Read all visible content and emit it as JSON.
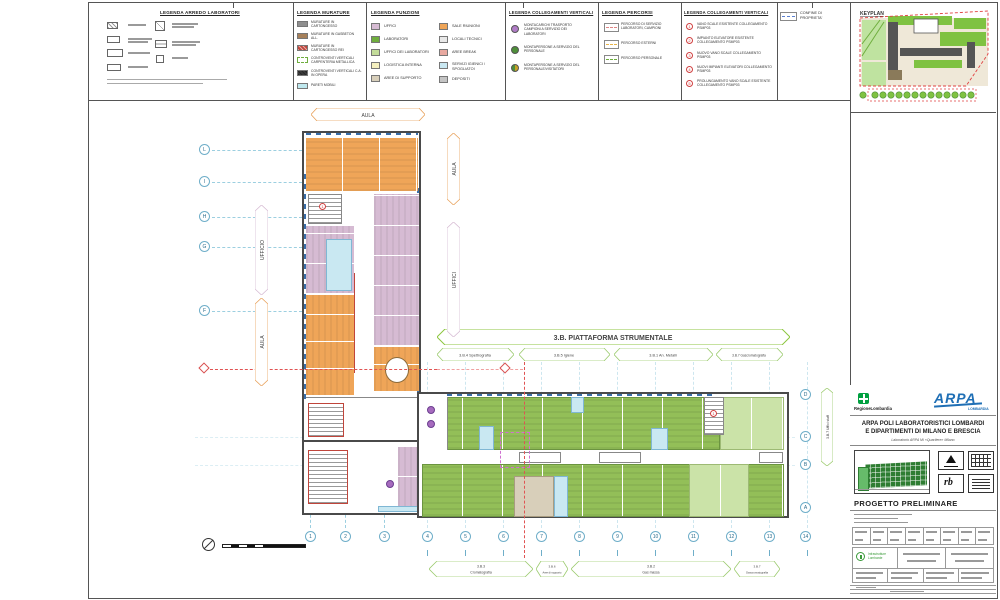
{
  "sheet": {
    "keyplan_title": "KEYPLAN",
    "confine_label": "CONFINE DI PROPRIETA'"
  },
  "colors": {
    "orange": "#EFA558",
    "pink": "#D6BBD3",
    "lab_green": "#93BF58",
    "lab_green_light": "#CBE3A8",
    "cyan": "#C9E8F2",
    "grid_blue": "#6FAEC9",
    "red": "#D94F4F",
    "hex_green": "#8CC63F",
    "beige": "#D8CFBA"
  },
  "legends": {
    "arredo": {
      "title": "LEGENDA ARREDO LABORATORI"
    },
    "murature": {
      "title": "LEGENDA MURATURE",
      "items": [
        {
          "label": "MURATURE IN CARTONGESSO",
          "color": "#8F8F8F"
        },
        {
          "label": "MURATURE IN GASBETON ALL.",
          "color": "#A6805A"
        },
        {
          "label": "MURATURE IN CARTONGESSO REI",
          "color": "#C0453B"
        },
        {
          "label": "CONTROVENTI VERTICALI CARPENTERIA METALLICA",
          "color": "#FFFFFF"
        },
        {
          "label": "CONTROVENTI VERTICALI C.A. IN OPERA",
          "color": "#3A3A3A"
        },
        {
          "label": "PARETI MOBILI",
          "color": "#BFE8EE"
        }
      ]
    },
    "funzioni": {
      "title": "LEGENDA FUNZIONI",
      "col1": [
        {
          "label": "UFFICI",
          "color": "#D6BBD3"
        },
        {
          "label": "LABORATORI",
          "color": "#6FAE3E"
        },
        {
          "label": "UFFICI DEI LABORATORI",
          "color": "#C3DC9A"
        },
        {
          "label": "LOGISTICA INTERNA",
          "color": "#F5F0C0"
        },
        {
          "label": "AREE DI SUPPORTO",
          "color": "#D8CFBA"
        }
      ],
      "col2": [
        {
          "label": "SALE RIUNIONI",
          "color": "#EFA558"
        },
        {
          "label": "LOCALI TECNICI",
          "color": "#E8E8E8"
        },
        {
          "label": "AREE BREAK",
          "color": "#E8A9A0"
        },
        {
          "label": "SERVIZI IGIENICI / SPOGLIATOI",
          "color": "#C9E8F2"
        },
        {
          "label": "DEPOSITI",
          "color": "#C4C4C4"
        }
      ]
    },
    "collegamenti1": {
      "title": "LEGENDA COLLEGAMENTI VERTICALI",
      "items": [
        {
          "label": "MONTACARICHI TRASPORTO CAMPIONI A SERVIZIO DEI LABORATORI",
          "color": "#B07CC6"
        },
        {
          "label": "MONTAPERSONE A SERVIZIO DEL PERSONALE",
          "color": "#4E8F3A"
        },
        {
          "label": "MONTAPERSONE A SERVIZIO DEL PERSONALE/VISITATORI",
          "color": "#4E8F3A"
        }
      ]
    },
    "percorsi": {
      "title": "LEGENDA PERCORSI",
      "items": [
        {
          "label": "PERCORSO DI SERVIZIO LABORATORI, CAMPIONI",
          "color": "#E08585"
        },
        {
          "label": "PERCORSO ESTERNI",
          "color": "#E8B54A"
        },
        {
          "label": "PERCORSO PERSONALE",
          "color": "#6FAE3E"
        }
      ]
    },
    "collegamenti2": {
      "title": "LEGENDA COLLEGAMENTI VERTICALI",
      "items": [
        {
          "num": "1",
          "label": "VANO SCALE ESISTENTE COLLEGAMENTO PSMP03"
        },
        {
          "num": "2",
          "label": "IMPIANTO ELEVATORE ESISTENTE COLLEGAMENTO PSMP03"
        },
        {
          "num": "3",
          "label": "NUOVO VANO SCALE COLLEGAMENTO PSMP03"
        },
        {
          "num": "4",
          "label": "NUOVI IMPIANTI ELEVATORI COLLEGAMENTO PSMP03"
        },
        {
          "num": "5",
          "label": "PROLUNGAMENTO VANO SCALE ESISTENTE COLLEGAMENTO PSMP03"
        }
      ]
    }
  },
  "plan": {
    "banner": "3.B. PIATTAFORMA STRUMENTALE",
    "top_labels": [
      {
        "text": "3.B.4 Spettrografia"
      },
      {
        "text": "3.B.5 Igiene"
      },
      {
        "text": "3.B.1 An. Metalli"
      },
      {
        "text": "3.B.7 Gascromatografia"
      }
    ],
    "bottom_labels": [
      {
        "code": "3.B.3",
        "name": "Cromatografia"
      },
      {
        "code": "3.B.6",
        "name": "Aree di supporto"
      },
      {
        "code": "3.B.2",
        "name": "Gas massa"
      },
      {
        "code": "3.B.7",
        "name": "Gascromatografia"
      }
    ],
    "area_labels": {
      "aula_top": "AULA",
      "aula_right": "AULA",
      "uffici_right": "UFFICI",
      "ufficio_left": "UFFICIO",
      "aula_left": "AULA",
      "staff_right": "3.B.7 Uffici staff"
    },
    "grid": {
      "bottom": [
        "1",
        "2",
        "3",
        "4",
        "5",
        "6",
        "7",
        "8",
        "9",
        "10",
        "11",
        "12",
        "13",
        "14"
      ],
      "right": [
        "D",
        "C",
        "B",
        "A"
      ],
      "left": [
        "L",
        "I",
        "H",
        "G",
        "F"
      ]
    },
    "stair_marker": "1"
  },
  "titleblock": {
    "region_logo": "RegioneLombardia",
    "arpa": "ARPA",
    "arpa_sub": "LOMBARDIA",
    "title_line1": "ARPA POLI LABORATORISTICI LOMBARDI",
    "title_line2": "E DIPARTIMENTI DI MILANO E BRESCIA",
    "subtitle": "Laboratorio ARPA MI «Quartiere» Milano",
    "phase": "PROGETTO PRELIMINARE",
    "infra_name": "Infrastrutture Lombarde",
    "rb": "rb"
  }
}
